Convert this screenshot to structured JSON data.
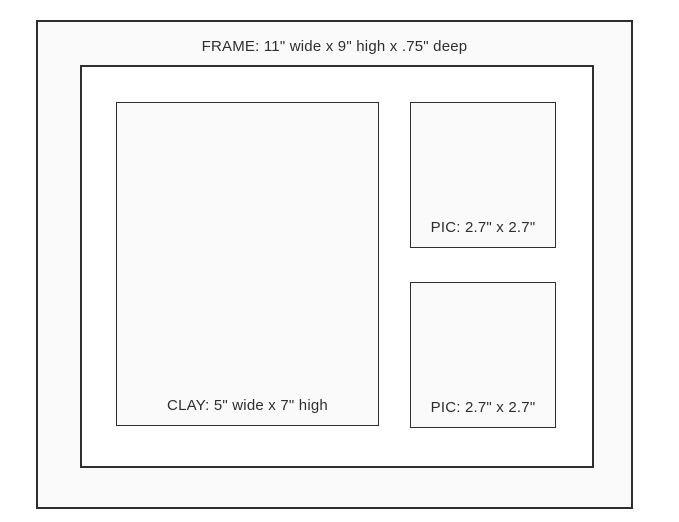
{
  "diagram": {
    "title": "Frame layout diagram",
    "frame": {
      "label": "FRAME: 11\" wide x 9\" high x .75\" deep",
      "width_in": 11,
      "height_in": 9,
      "depth_in": 0.75
    },
    "clay": {
      "label": "CLAY: 5\" wide x 7\" high",
      "width_in": 5,
      "height_in": 7
    },
    "pic_top": {
      "label": "PIC: 2.7\" x 2.7\"",
      "width_in": 2.7,
      "height_in": 2.7
    },
    "pic_bottom": {
      "label": "PIC: 2.7\" x 2.7\"",
      "width_in": 2.7,
      "height_in": 2.7
    },
    "colors": {
      "border": "#2e2e2e",
      "mat_fill": "#fafafa",
      "opening_fill": "#ffffff",
      "panel_fill": "#fafafa",
      "text": "#2e2e2e",
      "background": "#ffffff"
    }
  }
}
